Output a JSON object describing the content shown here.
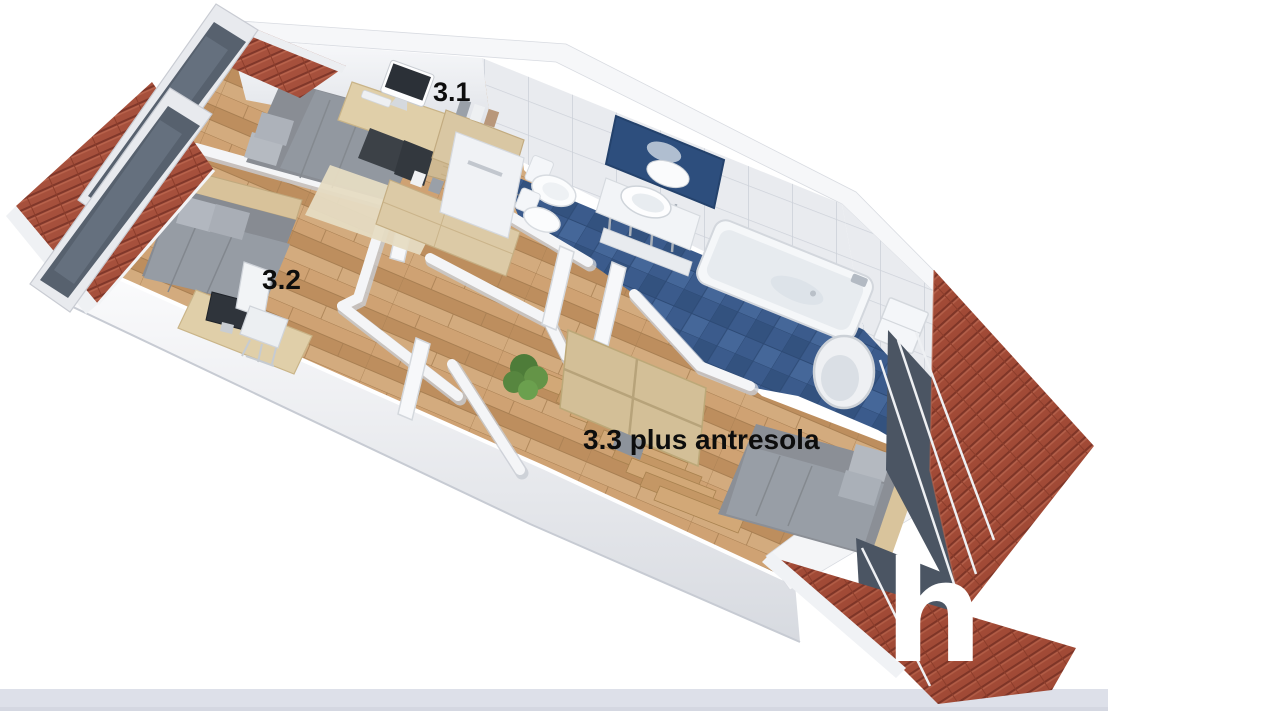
{
  "scene": {
    "description": "Isometric 3D render of an attic apartment floor plan with two bedrooms, a hallway with staircase, a blue-tiled bathroom, red tiled roof slopes and roof windows",
    "room_labels": [
      {
        "id": "room-3-1",
        "text": "3.1"
      },
      {
        "id": "room-3-2",
        "text": "3.2"
      },
      {
        "id": "room-3-3",
        "text": "3.3 plus antresola"
      }
    ],
    "watermark": {
      "text": "h"
    },
    "colors": {
      "roof_tile": "#a14a36",
      "roof_tile_dark": "#7e3527",
      "roof_tile_light": "#b4604a",
      "wood_floor": "#c89c6c",
      "bathroom_floor_tile": "#3b5b8c",
      "wall_white": "#f4f5f7",
      "wall_tile": "#e9ebef",
      "roof_glass": "#4b5563",
      "ground_band": "#dde0e9",
      "label_text": "#0d0d0d",
      "watermark_text": "#ffffff"
    }
  }
}
